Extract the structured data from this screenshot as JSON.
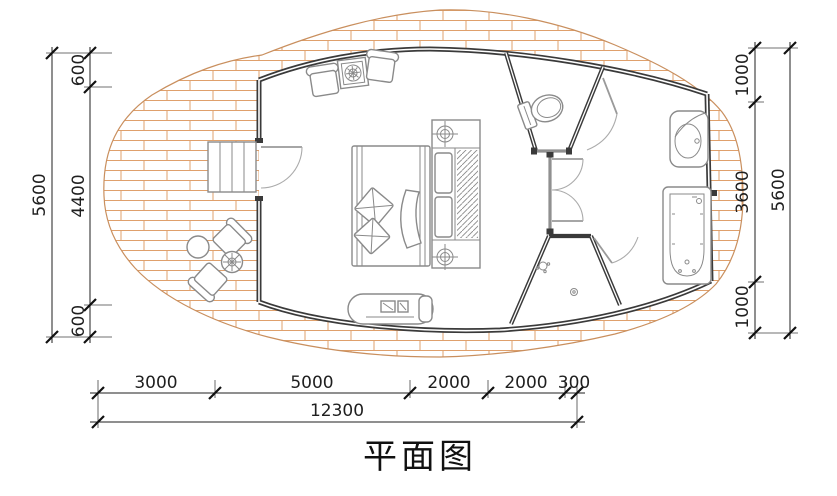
{
  "title": "平面图",
  "dimensions": {
    "left": {
      "total": "5600",
      "segments": [
        "600",
        "4400",
        "600"
      ]
    },
    "right": {
      "total": "5600",
      "segments": [
        "1000",
        "3600",
        "1000"
      ]
    },
    "bottom": {
      "total": "12300",
      "segments": [
        "3000",
        "5000",
        "2000",
        "2000",
        "300"
      ]
    }
  },
  "colors": {
    "background": "#ffffff",
    "brick_hatch": "#dfa06c",
    "deck_outline": "#c98f5e",
    "wall": "#3a3a3a",
    "partition_gray": "#909090",
    "furniture_line": "#8a8a8a",
    "dimension_line": "#1f1f1f"
  },
  "fixtures": [
    "brick-paved-deck",
    "entry-steps",
    "entry-door",
    "armchair",
    "side-table",
    "double-bed",
    "pillows",
    "duvet",
    "wardrobe-unit",
    "ceiling-lamp-symbol",
    "tv-console",
    "outdoor-chair",
    "round-table",
    "flower-table",
    "toilet",
    "wash-basin",
    "bathtub",
    "shower-drain",
    "interior-door"
  ]
}
